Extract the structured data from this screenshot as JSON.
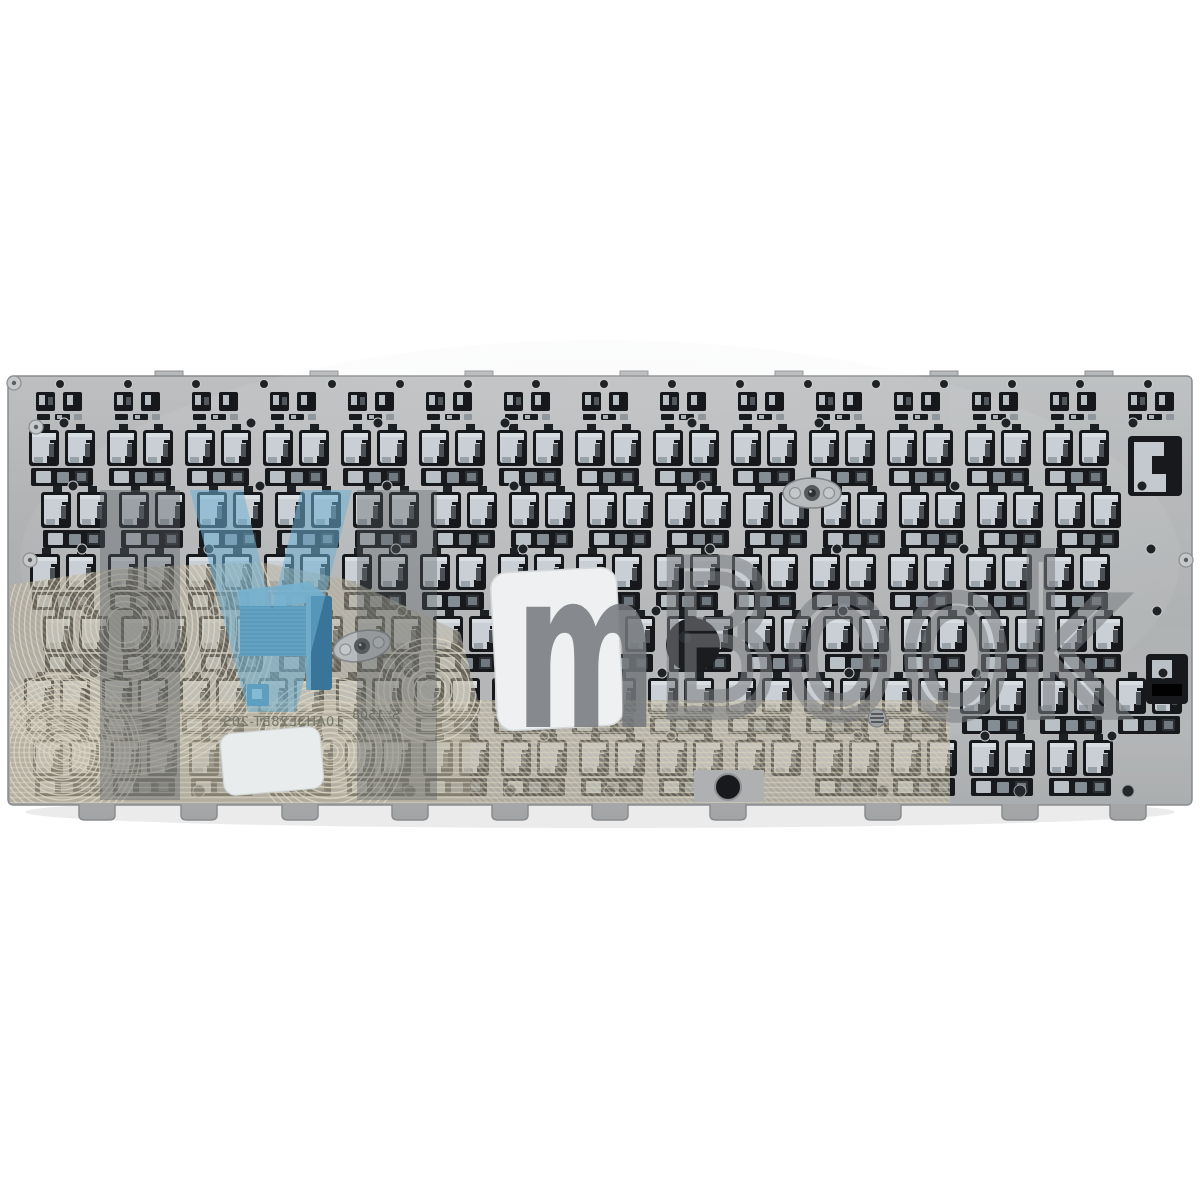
{
  "photo": {
    "description": "Rear view photo of a silver laptop keyboard replacement part: stamped metal backplate with rows of key-mount cutouts, beige membrane circuit traces at lower left, a folded blue flex cable, two blank white stickers, a black foam pad, two screw lugs and mirrored laser-etched part codes",
    "background_color": "#ffffff"
  },
  "plate": {
    "part_number": "10AH3E28BT-20S",
    "date_code": "S: 1508",
    "inscriptions_mirrored": "yes",
    "base_color": "#b2b4b6",
    "cutout_color": "#17191c",
    "clip_color": "#c9cfd4"
  },
  "membrane": {
    "base_color": "#b2aa96",
    "trace_color": "#e0d9c6"
  },
  "flex_cable": {
    "color": "#4e8cad"
  },
  "watermark": {
    "logo_letter": "M",
    "letter_m": "m",
    "word": "Book",
    "blue": "#6fb0d2",
    "gray": "#74787c"
  }
}
